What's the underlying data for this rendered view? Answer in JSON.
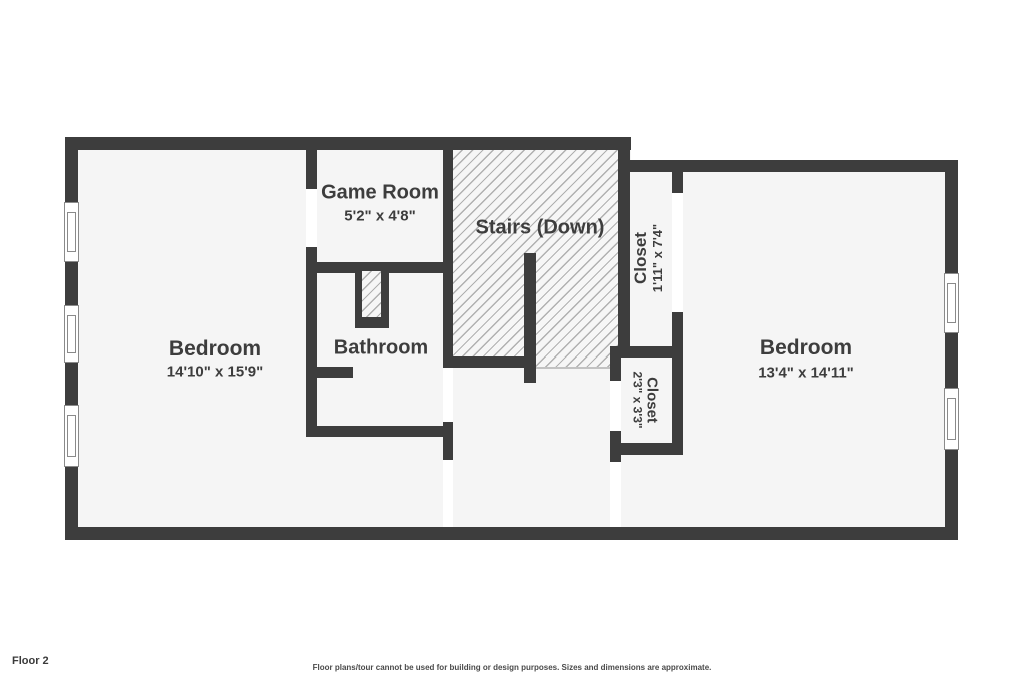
{
  "footer": {
    "floor_label": "Floor 2",
    "disclaimer": "Floor plans/tour cannot be used for building or design purposes. Sizes and dimensions are approximate."
  },
  "colors": {
    "wall": "#3d3d3d",
    "floor": "#f5f5f5",
    "hatch_line": "#b0b0b0",
    "text": "#3d3d3d",
    "door_opening": "#ffffff",
    "background": "#ffffff"
  },
  "rooms": [
    {
      "id": "bedroom-left",
      "name": "Bedroom",
      "dims": "14'10\" x 15'9\""
    },
    {
      "id": "game-room",
      "name": "Game Room",
      "dims": "5'2\" x 4'8\""
    },
    {
      "id": "bathroom",
      "name": "Bathroom",
      "dims": ""
    },
    {
      "id": "stairs",
      "name": "Stairs (Down)",
      "dims": ""
    },
    {
      "id": "closet-tall",
      "name": "Closet",
      "dims": "1'11\" x 7'4\""
    },
    {
      "id": "closet-small",
      "name": "Closet",
      "dims": "2'3\" x 3'3\""
    },
    {
      "id": "bedroom-right",
      "name": "Bedroom",
      "dims": "13'4\" x 14'11\""
    }
  ]
}
